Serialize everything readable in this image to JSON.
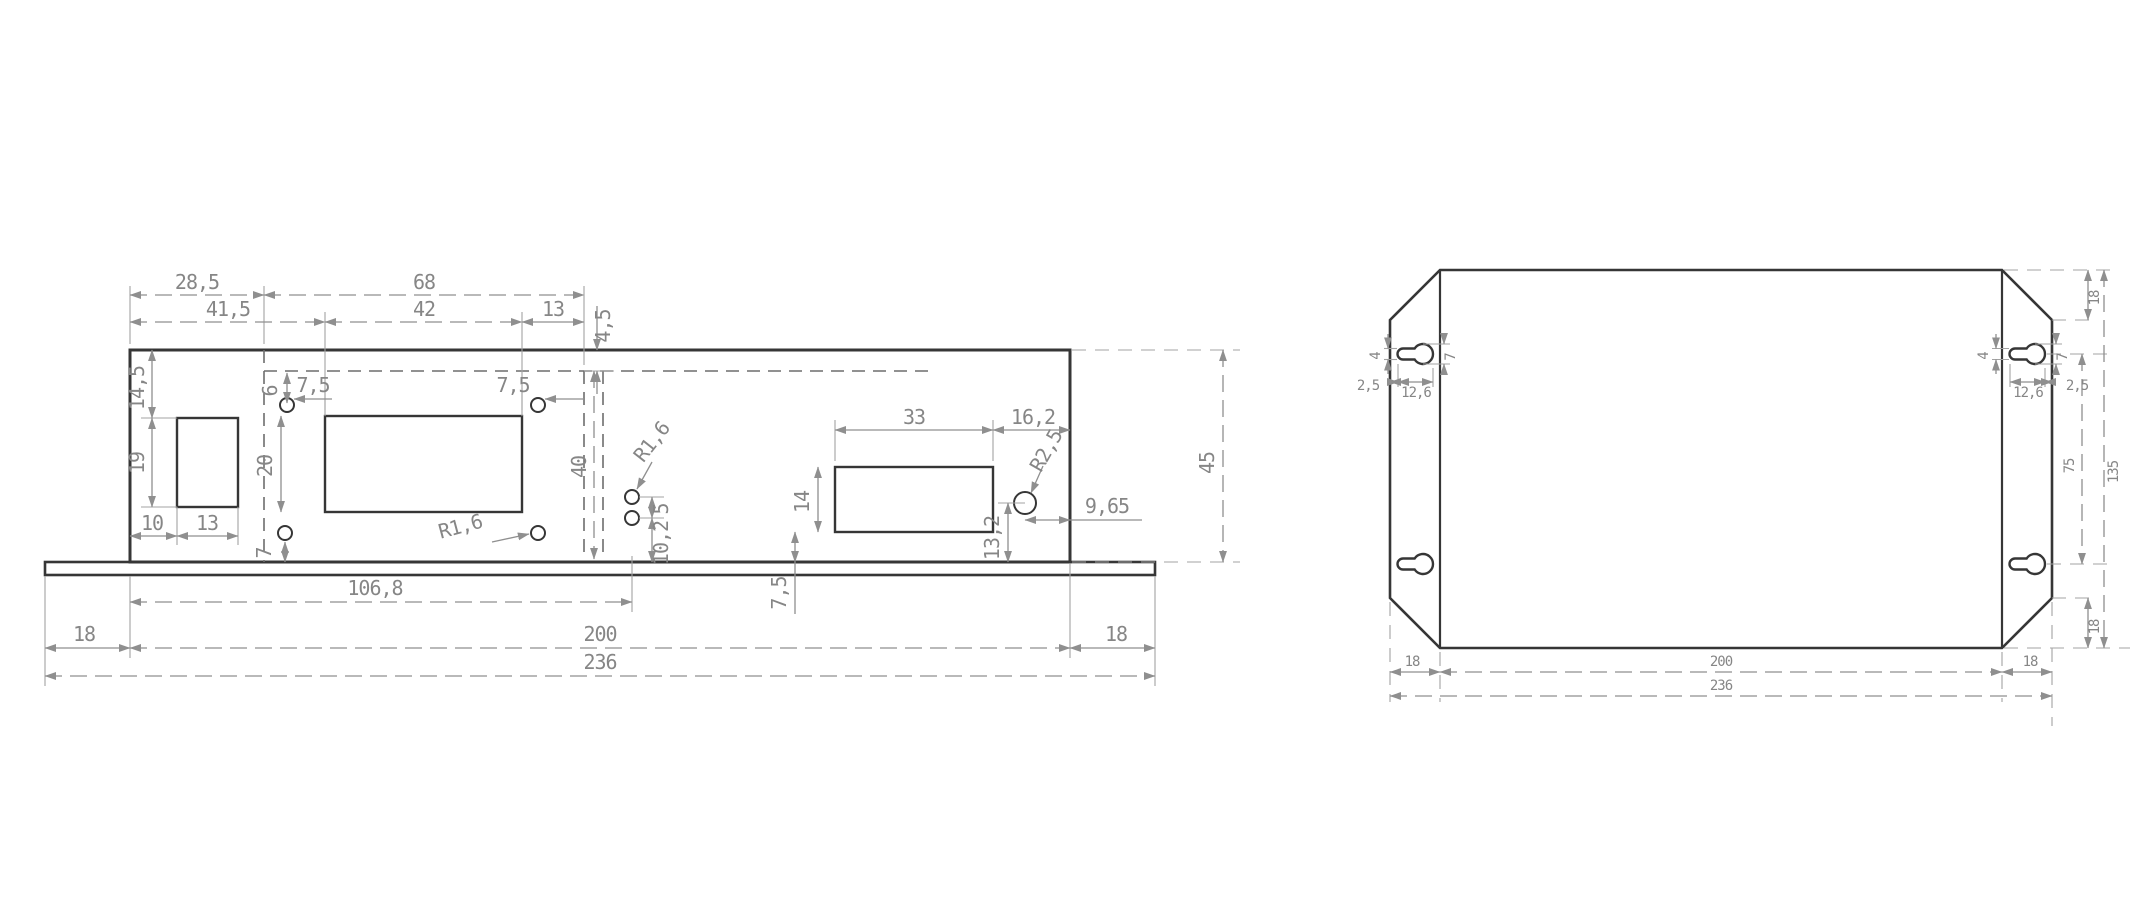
{
  "drawing": {
    "background": "#ffffff",
    "edge_color": "#363636",
    "dim_color": "#8f8f8f",
    "front_view": {
      "dims": {
        "w28_5": "28,5",
        "w41_5": "41,5",
        "w68": "68",
        "w42": "42",
        "w13": "13",
        "h4_5": "4,5",
        "h14_5": "14,5",
        "h19": "19",
        "w10": "10",
        "w13b": "13",
        "h6": "6",
        "w7_5a": "7,5",
        "w7_5b": "7,5",
        "h20": "20",
        "h40": "40",
        "r16a": "R1,6",
        "r16b": "R1,6",
        "h5": "5",
        "h10_2": "10,2",
        "h7": "7",
        "w33": "33",
        "w16_2": "16,2",
        "r2_5": "R2,5",
        "h14": "14",
        "h13_2": "13,2",
        "w9_65": "9,65",
        "h7_5": "7,5",
        "w106_8": "106,8",
        "w18l": "18",
        "w200": "200",
        "w18r": "18",
        "w236": "236",
        "h45": "45"
      }
    },
    "top_view": {
      "dims": {
        "tl4": "4",
        "tl2_5": "2,5",
        "tl12_6": "12,6",
        "tl7": "7",
        "tr4": "4",
        "tr12_6": "12,6",
        "tr2_5": "2,5",
        "tr7": "7",
        "r18t": "18",
        "r75": "75",
        "r135": "135",
        "r18b": "18",
        "b18l": "18",
        "b200": "200",
        "b18r": "18",
        "b236": "236"
      }
    }
  }
}
